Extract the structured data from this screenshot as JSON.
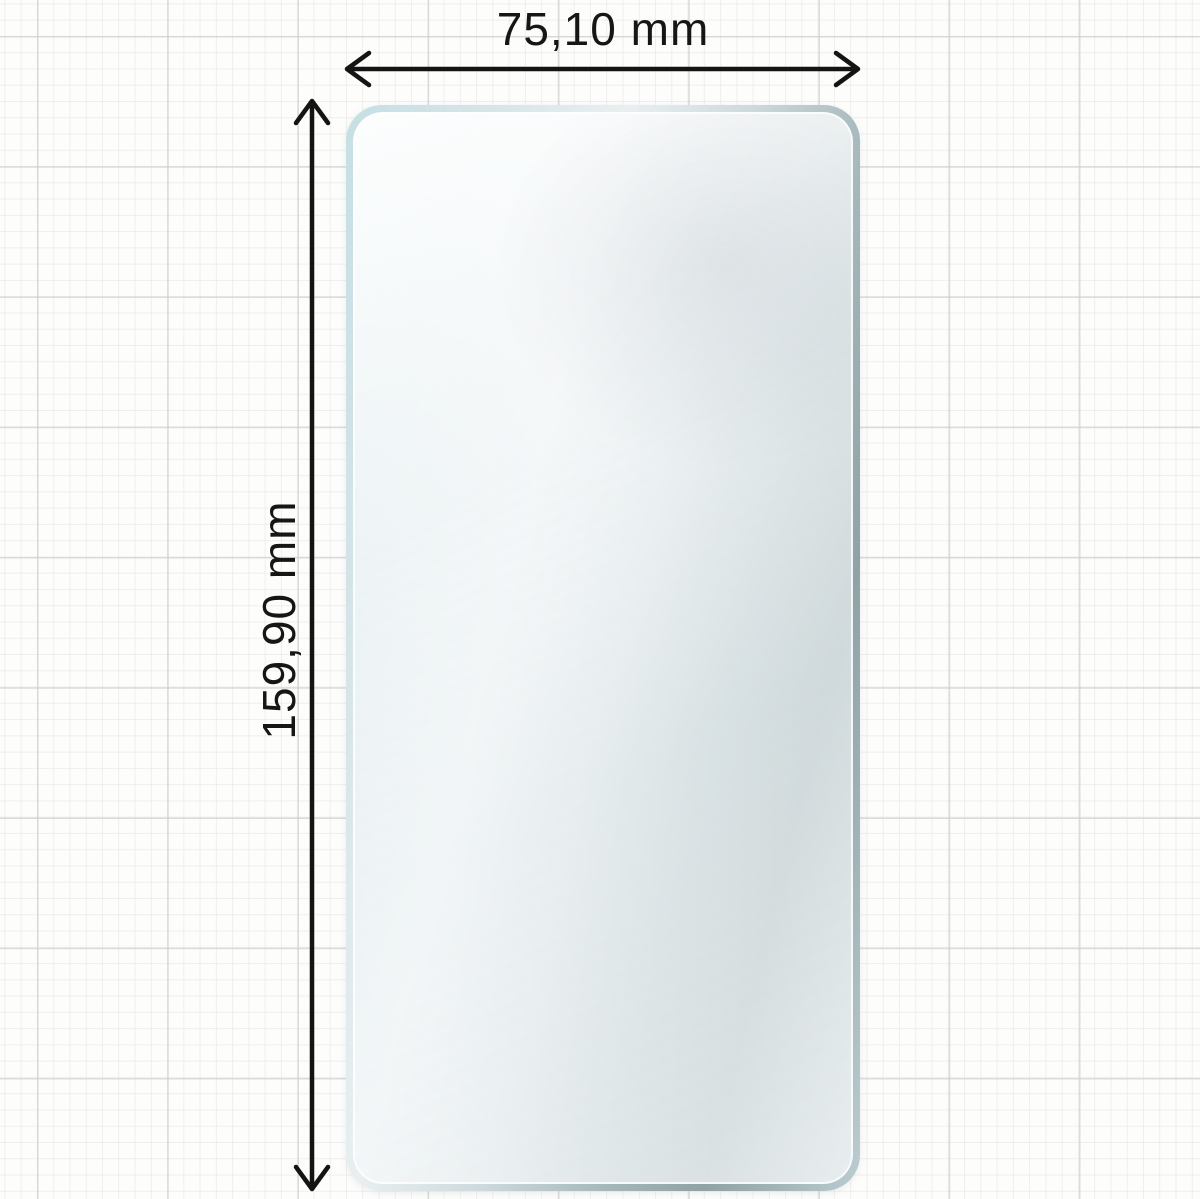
{
  "diagram": {
    "title": "screen protector dimension drawing",
    "width_dimension": {
      "label": "75,10 mm",
      "value_mm": 75.1,
      "orientation": "horizontal"
    },
    "height_dimension": {
      "label": "159,90 mm",
      "value_mm": 159.9,
      "orientation": "vertical"
    }
  },
  "colors": {
    "ink": "#161616",
    "paper": "#fdfdfc",
    "grid_minor": "#e8e5e2",
    "grid_major": "#cdcbc9",
    "glass_rim_cyan": "#c6dfe3",
    "glass_rim_slate": "#8fa2a6",
    "glass_fill": "#f2f5f7"
  }
}
